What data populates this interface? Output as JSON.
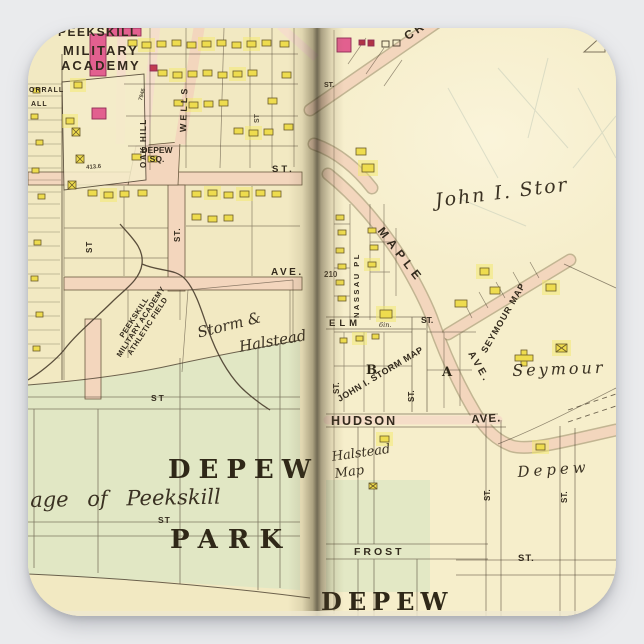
{
  "scene": {
    "description": "square sticker product photo of a vintage Peekskill NY atlas map spread",
    "background": "#eaebed"
  },
  "colors": {
    "paper_left": "#f2e9c2",
    "paper_right": "#f6eecb",
    "park_green": "#e1e7c4",
    "road_pink": "#f3d6bd",
    "building_yellow": "#eedc4e",
    "building_pink": "#e2608f",
    "ink": "#3a3122"
  },
  "left_page": {
    "peekskill": "PEEKSKILL",
    "military": "MILITARY",
    "academy": "ACADEMY",
    "orrall": "ORRALL",
    "hall": "ALL",
    "oak_hill": "OAK HILL",
    "wells": "WELLS",
    "num_7946": "7946",
    "depew_sq_1": "DEPEW",
    "depew_sq_2": "SQ.",
    "num_4136": "413.6",
    "st_main": "ST.",
    "st_vert_a": "ST",
    "st_vert_b": "ST.",
    "st_vert_top": "ST",
    "ave": "AVE.",
    "athletic_1": "PEEKSKILL",
    "athletic_2": "MILITARY ACADEMY",
    "athletic_3": "ATHLETIC FIELD",
    "storm_1": "Storm &",
    "storm_2": "Halstead",
    "st_park_upper": "ST",
    "depew_big": "DEPEW",
    "village": "age of Peekskill",
    "st_park_small": "ST",
    "park_big": "PARK"
  },
  "right_page": {
    "cro": "CRO",
    "st_gutter": "ST.",
    "john_stor": "John I. Stor",
    "maple": "MAPLE",
    "num_210": "210",
    "nassau_pl": "NASSAU PL",
    "elm": "ELM",
    "six_in": "6in.",
    "st_elm": "ST.",
    "storm_map": "JOHN I. STORM MAP",
    "block_b": "B",
    "block_a": "A",
    "st_vert_c": "ST.",
    "st_vert_d": "ST.",
    "hudson": "HUDSON",
    "hudson_ave": "AVE.",
    "seymour_map": "SEYMOUR MAP",
    "seymour_ave": "AVE.",
    "seymour": "Seymour",
    "halstead_1": "Halstead",
    "halstead_2": "Map",
    "frost": "FROST",
    "st_frost": "ST.",
    "depew_italic": "Depew",
    "st_vert_e": "ST.",
    "st_vert_f": "ST.",
    "depew_bottom": "DEPEW"
  }
}
